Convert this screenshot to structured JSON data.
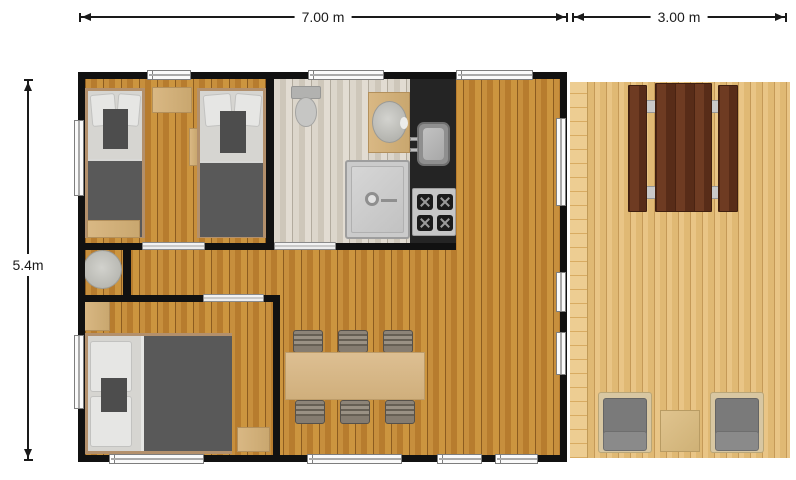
{
  "dimensions": {
    "main_width_label": "7.00 m",
    "deck_width_label": "3.00 m",
    "height_label": "5.4m"
  },
  "colors": {
    "wall": "#111111",
    "dimension": "#1a1a1a",
    "wood_floor": "#c08a3e",
    "bath_floor": "#d8d2c7",
    "deck_floor": "#e5c080",
    "kitchen_counter": "#242424",
    "stove_panel": "#c6c6c6",
    "bed_frame": "#b3906c",
    "bed_linen": "#d6d5d1",
    "bed_duvet": "#595959",
    "cushion_dark": "#4d4d4d",
    "furniture_wood": "#d4b184",
    "picnic_wood": "#5f2f1d",
    "armchair_frame": "#d8c7a2",
    "armchair_cushion": "#7a7a7a",
    "fixture_gray": "#c0c0be"
  }
}
